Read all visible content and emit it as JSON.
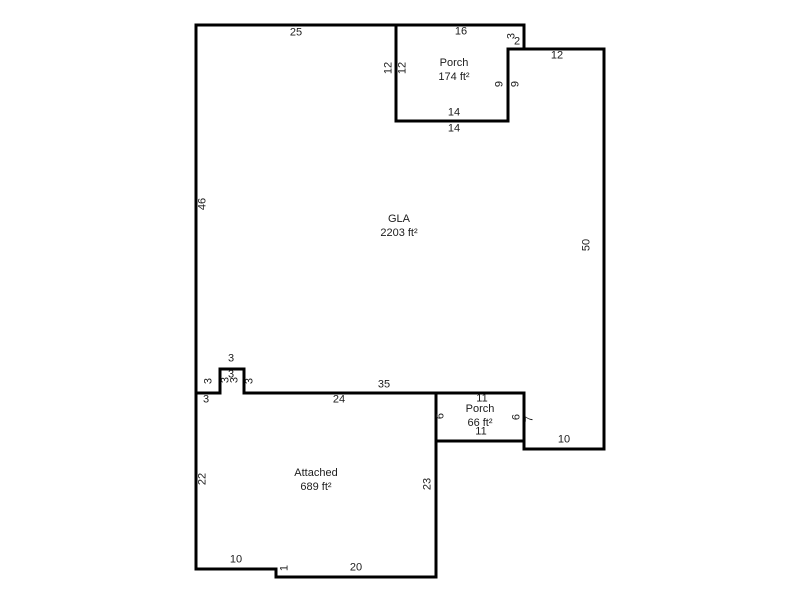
{
  "sketch": {
    "units": "ft",
    "background": "#ffffff",
    "wall_color": "#000000",
    "label_color": "#1c1c1c",
    "areas": [
      {
        "name": "GLA",
        "area": "2203 ft²",
        "label_px": {
          "x": 399,
          "y": 226
        },
        "points_ft": [
          [
            0,
            0
          ],
          [
            25,
            0
          ],
          [
            25,
            12
          ],
          [
            39,
            12
          ],
          [
            39,
            3
          ],
          [
            51,
            3
          ],
          [
            51,
            53
          ],
          [
            41,
            53
          ],
          [
            41,
            46
          ],
          [
            6,
            46
          ],
          [
            6,
            43
          ],
          [
            3,
            43
          ],
          [
            3,
            46
          ],
          [
            0,
            46
          ]
        ]
      },
      {
        "name": "Porch",
        "area": "174 ft²",
        "label_px": {
          "x": 454,
          "y": 70
        },
        "points_ft": [
          [
            25,
            0
          ],
          [
            41,
            0
          ],
          [
            41,
            3
          ],
          [
            39,
            3
          ],
          [
            39,
            12
          ],
          [
            25,
            12
          ]
        ]
      },
      {
        "name": "Porch",
        "area": "66 ft²",
        "label_px": {
          "x": 480,
          "y": 416
        },
        "points_ft": [
          [
            30,
            46
          ],
          [
            41,
            46
          ],
          [
            41,
            52
          ],
          [
            30,
            52
          ]
        ]
      },
      {
        "name": "Attached",
        "area": "689 ft²",
        "label_px": {
          "x": 316,
          "y": 480
        },
        "points_ft": [
          [
            0,
            46
          ],
          [
            3,
            46
          ],
          [
            3,
            43
          ],
          [
            6,
            43
          ],
          [
            6,
            46
          ],
          [
            30,
            46
          ],
          [
            30,
            69
          ],
          [
            10,
            69
          ],
          [
            10,
            68
          ],
          [
            0,
            68
          ]
        ]
      }
    ],
    "dimensions": [
      {
        "text": "25",
        "x": 296,
        "y": 33,
        "rot": false
      },
      {
        "text": "16",
        "x": 461,
        "y": 32,
        "rot": false
      },
      {
        "text": "3",
        "x": 512,
        "y": 36,
        "rot": true
      },
      {
        "text": "2",
        "x": 517,
        "y": 42,
        "rot": false
      },
      {
        "text": "12",
        "x": 389,
        "y": 68,
        "rot": true
      },
      {
        "text": "12",
        "x": 403,
        "y": 68,
        "rot": true
      },
      {
        "text": "9",
        "x": 500,
        "y": 84,
        "rot": true
      },
      {
        "text": "9",
        "x": 516,
        "y": 84,
        "rot": true
      },
      {
        "text": "14",
        "x": 454,
        "y": 113,
        "rot": false
      },
      {
        "text": "14",
        "x": 454,
        "y": 129,
        "rot": false
      },
      {
        "text": "12",
        "x": 557,
        "y": 56,
        "rot": false
      },
      {
        "text": "50",
        "x": 587,
        "y": 245,
        "rot": true
      },
      {
        "text": "46",
        "x": 203,
        "y": 204,
        "rot": true
      },
      {
        "text": "3",
        "x": 231,
        "y": 359,
        "rot": false
      },
      {
        "text": "3",
        "x": 231,
        "y": 375,
        "rot": false
      },
      {
        "text": "3",
        "x": 209,
        "y": 381,
        "rot": true
      },
      {
        "text": "3",
        "x": 226,
        "y": 380,
        "rot": true
      },
      {
        "text": "3",
        "x": 235,
        "y": 380,
        "rot": true
      },
      {
        "text": "3",
        "x": 250,
        "y": 381,
        "rot": true
      },
      {
        "text": "3",
        "x": 206,
        "y": 400,
        "rot": false
      },
      {
        "text": "35",
        "x": 384,
        "y": 385,
        "rot": false
      },
      {
        "text": "24",
        "x": 339,
        "y": 400,
        "rot": false
      },
      {
        "text": "11",
        "x": 482,
        "y": 399,
        "rot": false
      },
      {
        "text": "11",
        "x": 481,
        "y": 432,
        "rot": false
      },
      {
        "text": "6",
        "x": 441,
        "y": 416,
        "rot": true
      },
      {
        "text": "6",
        "x": 517,
        "y": 417,
        "rot": true
      },
      {
        "text": "7",
        "x": 530,
        "y": 419,
        "rot": true
      },
      {
        "text": "10",
        "x": 564,
        "y": 440,
        "rot": false
      },
      {
        "text": "22",
        "x": 203,
        "y": 479,
        "rot": true
      },
      {
        "text": "23",
        "x": 428,
        "y": 484,
        "rot": true
      },
      {
        "text": "10",
        "x": 236,
        "y": 560,
        "rot": false
      },
      {
        "text": "1",
        "x": 285,
        "y": 568,
        "rot": true
      },
      {
        "text": "20",
        "x": 356,
        "y": 568,
        "rot": false
      }
    ]
  }
}
